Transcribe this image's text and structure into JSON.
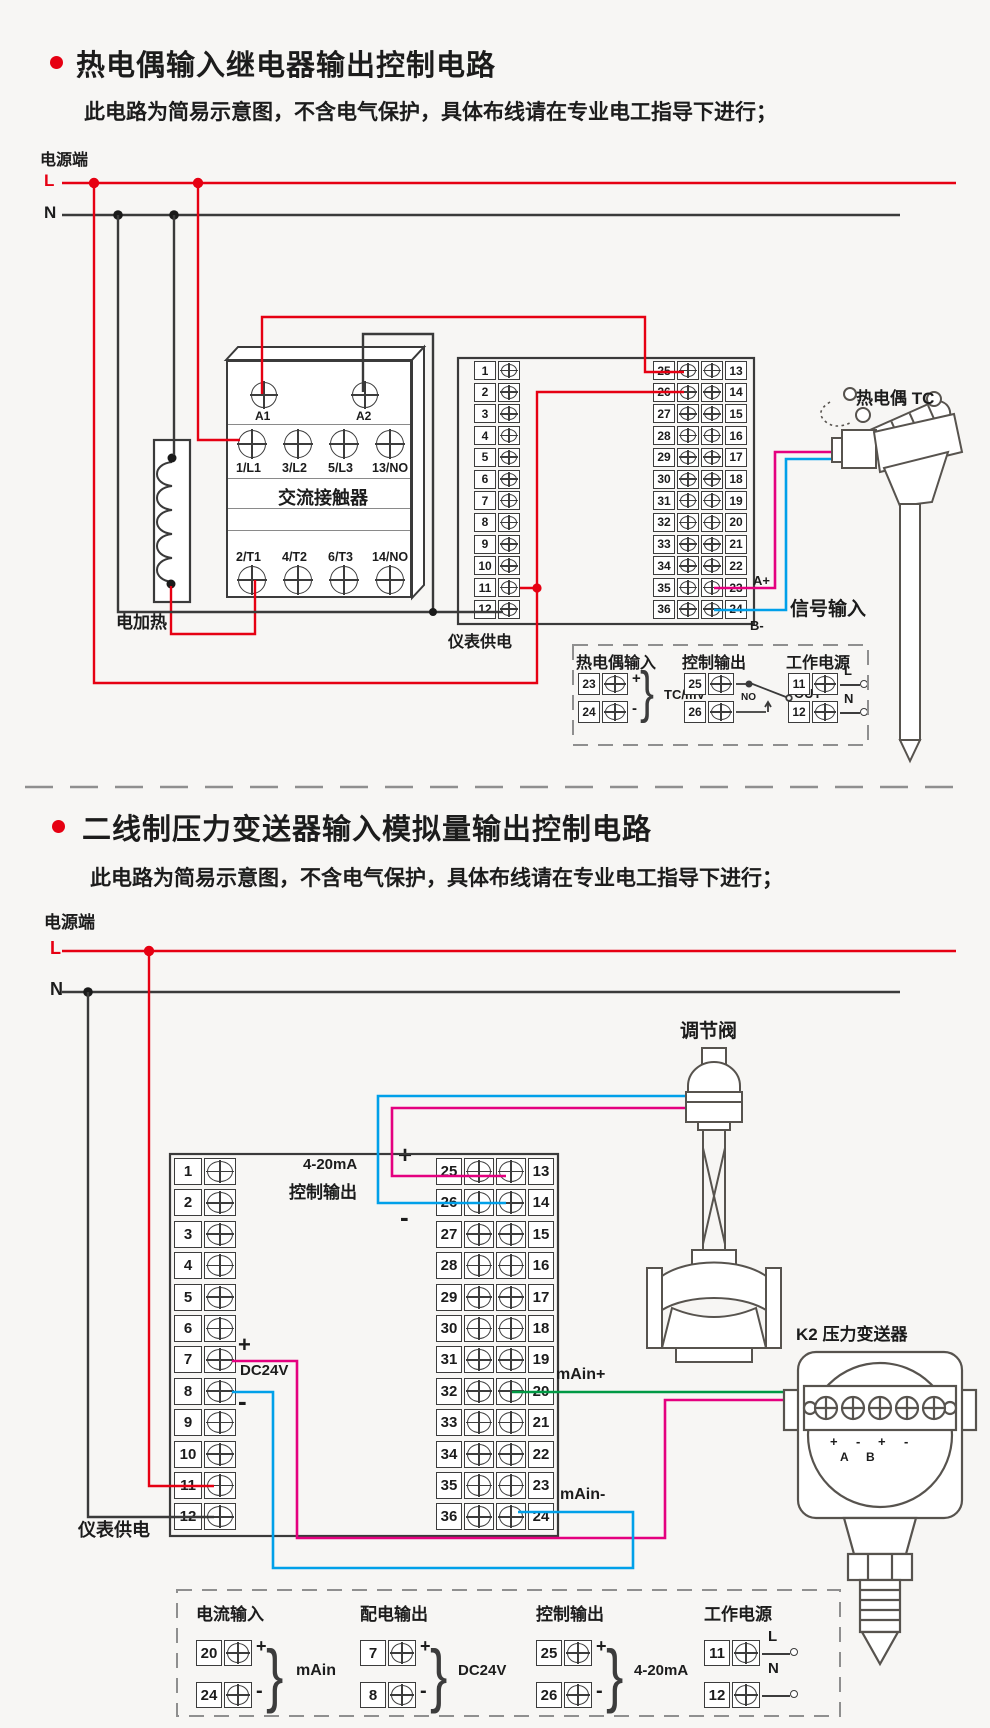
{
  "colors": {
    "wire_live": "#e60012",
    "wire_neutral": "#3a3a3a",
    "wire_magenta": "#e4007f",
    "wire_blue": "#00a0e9",
    "wire_green": "#009944",
    "accent": "#e60012"
  },
  "section1": {
    "title": "热电偶输入继电器输出控制电路",
    "subtitle": "此电路为简易示意图，不含电气保护，具体布线请在专业电工指导下进行；",
    "power": {
      "label": "电源端",
      "live": "L",
      "neutral": "N"
    },
    "contactor": {
      "name": "交流接触器",
      "coil_a1": "A1",
      "coil_a2": "A2",
      "row_top": [
        "1/L1",
        "3/L2",
        "5/L3",
        "13/NO"
      ],
      "row_bottom": [
        "2/T1",
        "4/T2",
        "6/T3",
        "14/NO"
      ]
    },
    "heater_label": "电加热",
    "supply_label": "仪表供电",
    "signal": {
      "a_plus": "A+",
      "b_minus": "B-",
      "label": "信号输入"
    },
    "tc_label": "热电偶 TC",
    "terminals": {
      "left": [
        "1",
        "2",
        "3",
        "4",
        "5",
        "6",
        "7",
        "8",
        "9",
        "10",
        "11",
        "12"
      ],
      "mid": [
        "25",
        "26",
        "27",
        "28",
        "29",
        "30",
        "31",
        "32",
        "33",
        "34",
        "35",
        "36"
      ],
      "right": [
        "13",
        "14",
        "15",
        "16",
        "17",
        "18",
        "19",
        "20",
        "21",
        "22",
        "23",
        "24"
      ]
    },
    "legend": {
      "tc_input": {
        "title": "热电偶输入",
        "t1": "23",
        "m1": "+",
        "t2": "24",
        "m2": "-",
        "note": "TC/mV"
      },
      "ctrl_out": {
        "title": "控制输出",
        "t1": "25",
        "t2": "26",
        "no": "NO",
        "out": "OUT"
      },
      "work_pwr": {
        "title": "工作电源",
        "t1": "11",
        "m1": "L",
        "t2": "12",
        "m2": "N"
      }
    }
  },
  "section2": {
    "title": "二线制压力变送器输入模拟量输出控制电路",
    "subtitle": "此电路为简易示意图，不含电气保护，具体布线请在专业电工指导下进行；",
    "power": {
      "label": "电源端",
      "live": "L",
      "neutral": "N"
    },
    "valve_label": "调节阀",
    "out420": {
      "line1": "4-20mA",
      "line2": "控制输出",
      "plus": "+",
      "minus": "-"
    },
    "dc24": {
      "plus": "+",
      "label": "DC24V",
      "minus": "-"
    },
    "main_plus": "mAin+",
    "main_minus": "mAin-",
    "supply_label": "仪表供电",
    "transmitter": {
      "label": "K2 压力变送器",
      "a": "A",
      "b": "B",
      "marks": [
        "+",
        "-",
        "+",
        "-"
      ]
    },
    "terminals": {
      "left": [
        "1",
        "2",
        "3",
        "4",
        "5",
        "6",
        "7",
        "8",
        "9",
        "10",
        "11",
        "12"
      ],
      "mid": [
        "25",
        "26",
        "27",
        "28",
        "29",
        "30",
        "31",
        "32",
        "33",
        "34",
        "35",
        "36"
      ],
      "right": [
        "13",
        "14",
        "15",
        "16",
        "17",
        "18",
        "19",
        "20",
        "21",
        "22",
        "23",
        "24"
      ]
    },
    "legend": {
      "cur_in": {
        "title": "电流输入",
        "t1": "20",
        "m1": "+",
        "t2": "24",
        "m2": "-",
        "note": "mAin"
      },
      "dist_out": {
        "title": "配电输出",
        "t1": "7",
        "m1": "+",
        "t2": "8",
        "m2": "-",
        "note": "DC24V"
      },
      "ctrl_out": {
        "title": "控制输出",
        "t1": "25",
        "m1": "+",
        "t2": "26",
        "m2": "-",
        "note": "4-20mA"
      },
      "work_pwr": {
        "title": "工作电源",
        "t1": "11",
        "m1": "L",
        "t2": "12",
        "m2": "N"
      }
    }
  }
}
